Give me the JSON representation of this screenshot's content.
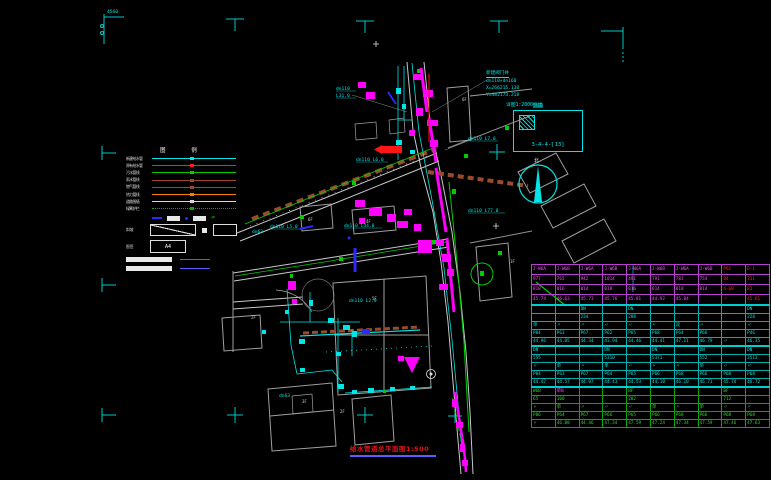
{
  "legend": {
    "header": "图 例",
    "rows": [
      {
        "label": "新建给水管",
        "color": "#00e5e5"
      },
      {
        "label": "原有给水管",
        "color": "#ff2020"
      },
      {
        "label": "污水管线",
        "color": "#00cc00"
      },
      {
        "label": "雨水管线",
        "color": "#a0452c"
      },
      {
        "label": "燃气管线",
        "color": "#a0452c"
      },
      {
        "label": "热力管线",
        "color": "#ff8000"
      },
      {
        "label": "道路围墙",
        "color": "#d8d8d8"
      },
      {
        "label": "绿篱护栏",
        "color": "#00b000",
        "dotted": true
      }
    ],
    "slope_label": "斜坡",
    "box_label": "图签",
    "box_value": "A4"
  },
  "valve_note": {
    "l1": "新建阀门井",
    "l2": "dn110×dn160",
    "l3": "X=266215.138",
    "l4": "Y=482173.218"
  },
  "detail_box": {
    "note": "详图1:2000",
    "note_hl": "引出",
    "code": "3-4-4-[13]"
  },
  "north_label": "北",
  "corner_label": "4560",
  "title_block": {
    "text": "给水管道总平面图1:500"
  },
  "ann": [
    {
      "t": "dn110"
    },
    {
      "t": "L31.0"
    },
    {
      "t": "dn110 L6.0"
    },
    {
      "t": "dn110 L5.0"
    },
    {
      "t": "dn110 L44.0"
    },
    {
      "t": "dn110 L77.0"
    },
    {
      "t": "dn110 L7.0"
    },
    {
      "t": "dn63"
    },
    {
      "t": "dn63"
    },
    {
      "t": "dn110 L2.0"
    }
  ],
  "wlab": [
    {
      "t": "6F"
    },
    {
      "t": "4F"
    },
    {
      "t": "5F"
    },
    {
      "t": "2F"
    },
    {
      "t": "3F"
    },
    {
      "t": "1F"
    },
    {
      "t": "6F"
    },
    {
      "t": "2F"
    }
  ],
  "table": {
    "sections": [
      {
        "k": "A",
        "rows": [
          {
            "c": [
              "J-W6A",
              "J-W6B",
              "J-W6A",
              "J-W6B",
              "J-W6A",
              "J-W6B",
              "J-W6A",
              "J-W6B",
              "P92",
              "D-1"
            ],
            "ov": {
              "8": "r",
              "9": "r"
            }
          },
          {
            "c": [
              "977",
              "765",
              "942",
              "1014",
              "491",
              "791",
              "783",
              "754",
              "84",
              "311"
            ],
            "ov": {
              "8": "r",
              "9": "r"
            }
          },
          {
            "c": [
              "818",
              "816",
              "814",
              "818",
              "816",
              "814",
              "818",
              "814",
              "4-6B",
              "81"
            ],
            "ov": {
              "8": "r",
              "9": "r"
            }
          },
          {
            "c": [
              "45.74",
              "46.63",
              "45.73",
              "45.76",
              "45.81",
              "44.92",
              "45.84",
              "",
              "〃",
              "45.61"
            ],
            "ov": {
              "8": "r",
              "9": "r"
            }
          }
        ]
      },
      {
        "k": "B",
        "rows": [
          {
            "c": [
              "",
              "",
              "DN",
              "",
              "DN",
              "",
              "",
              "",
              "",
              "DN"
            ]
          },
          {
            "c": [
              "",
              "",
              "234",
              "",
              "288",
              "",
              "",
              "",
              "",
              "228"
            ]
          },
          {
            "c": [
              "单",
              "〃",
              "〃",
              "〃",
              "〃",
              "〃",
              "双",
              "〃",
              "",
              "〃"
            ]
          },
          {
            "c": [
              "P84",
              "P63",
              "P67",
              "P62",
              "P65",
              "P68",
              "P64",
              "P66",
              "",
              "P46"
            ]
          },
          {
            "c": [
              "44.96",
              "44.85",
              "44.34",
              "43.94",
              "44.46",
              "44.41",
              "47.11",
              "46.79",
              "〃",
              "46.35"
            ]
          }
        ]
      },
      {
        "k": "C",
        "rows": [
          {
            "c": [
              "DN",
              "",
              "",
              "DN",
              "",
              "DN",
              "",
              "DN",
              "",
              "DN"
            ]
          },
          {
            "c": [
              "555",
              "",
              "",
              "5310",
              "",
              "5371",
              "",
              "552",
              "",
              "2513"
            ]
          },
          {
            "c": [
              "〃",
              "单",
              "〃",
              "单",
              "〃",
              "〃",
              "〃",
              "单",
              "〃",
              "〃"
            ]
          },
          {
            "c": [
              "P84",
              "P63",
              "P67",
              "P64",
              "P65",
              "P66",
              "P68",
              "P66",
              "P68",
              "P68"
            ]
          },
          {
            "c": [
              "44.47",
              "44.57",
              "44.07",
              "44.43",
              "44.53",
              "44.10",
              "46.10",
              "46.71",
              "45.74",
              "46.72"
            ]
          }
        ]
      },
      {
        "k": "D",
        "rows": [
          {
            "c": [
              "W6B",
              "单B",
              "",
              "",
              "BF",
              "",
              "",
              "",
              "BF",
              ""
            ],
            "ov": {
              "1": "m"
            }
          },
          {
            "c": [
              "65",
              "100",
              "",
              "",
              "202",
              "",
              "",
              "",
              "712",
              ""
            ]
          },
          {
            "c": [
              "〃",
              "单",
              "〃",
              "〃",
              "〃",
              "单",
              "〃",
              "单",
              "〃",
              "〃"
            ]
          },
          {
            "c": [
              "P86",
              "P64",
              "P67",
              "P66",
              "P65",
              "P66",
              "P68",
              "P66",
              "P68",
              "P68"
            ]
          },
          {
            "c": [
              "〃",
              "46.88",
              "44.46",
              "47.34",
              "47.59",
              "47.24",
              "47.34",
              "47.59",
              "47.46",
              "47.63"
            ]
          }
        ]
      }
    ]
  }
}
